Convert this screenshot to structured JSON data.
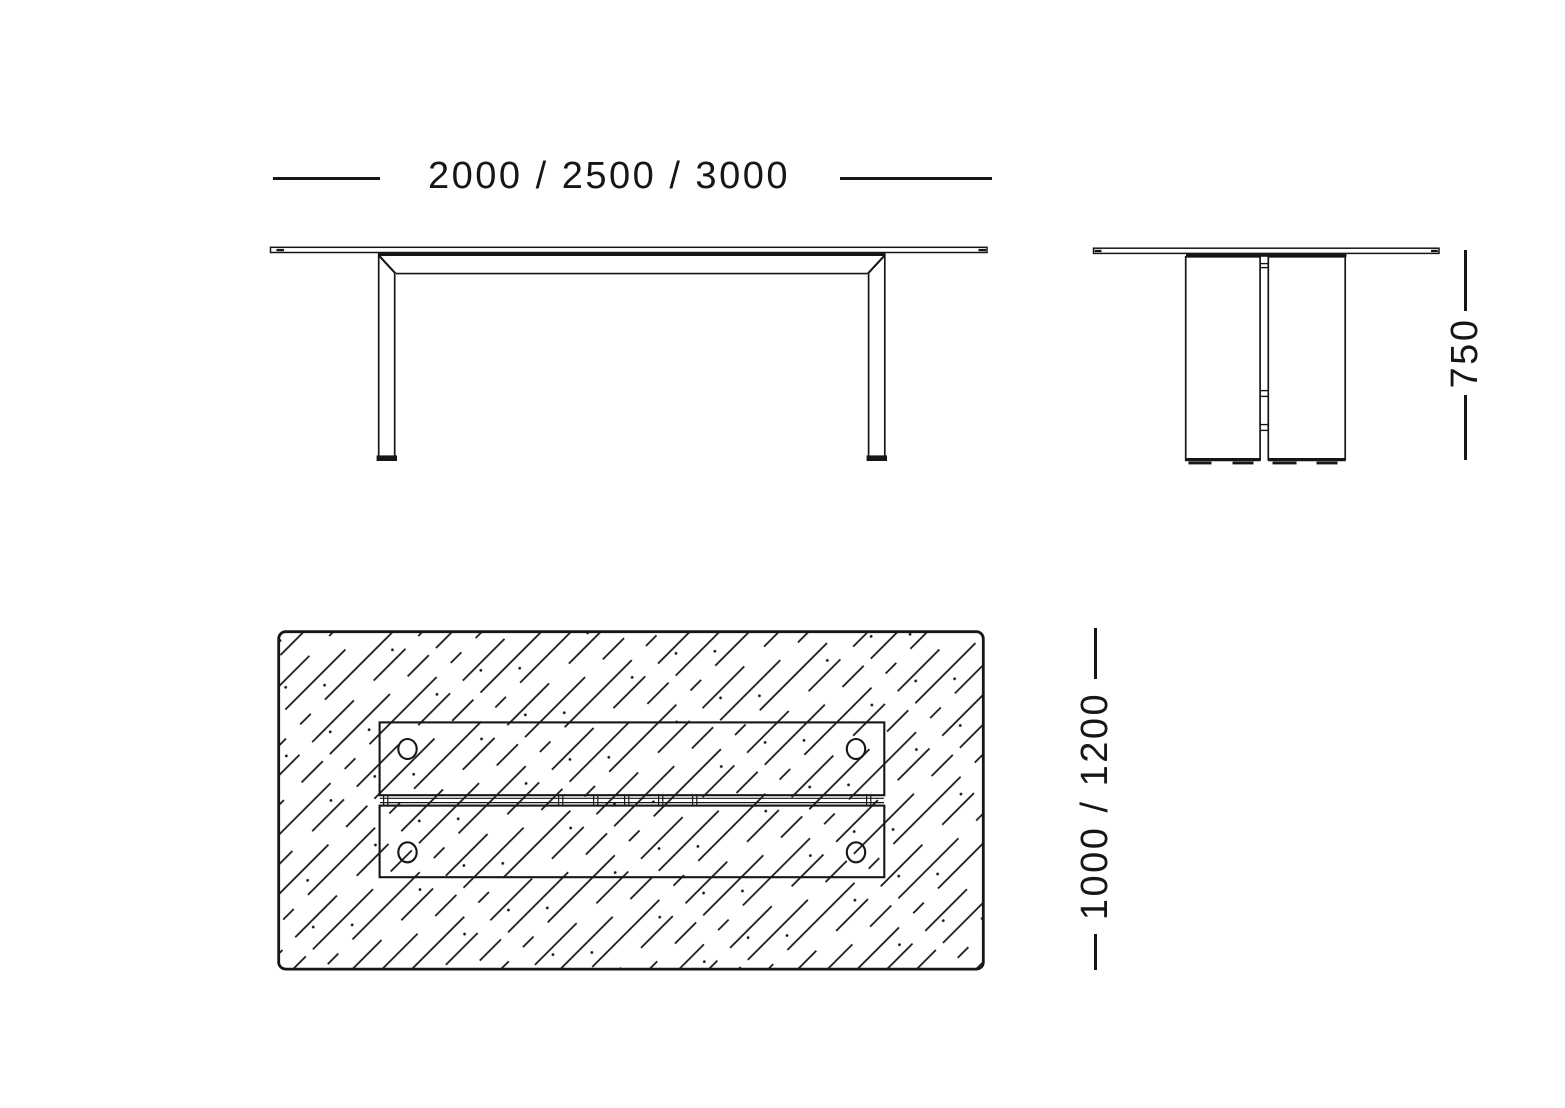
{
  "colors": {
    "background": "#ffffff",
    "ink": "#161616"
  },
  "dimensions": {
    "length_label": "2000 / 2500 / 3000",
    "height_label": "750",
    "depth_label": "1000 / 1200"
  }
}
